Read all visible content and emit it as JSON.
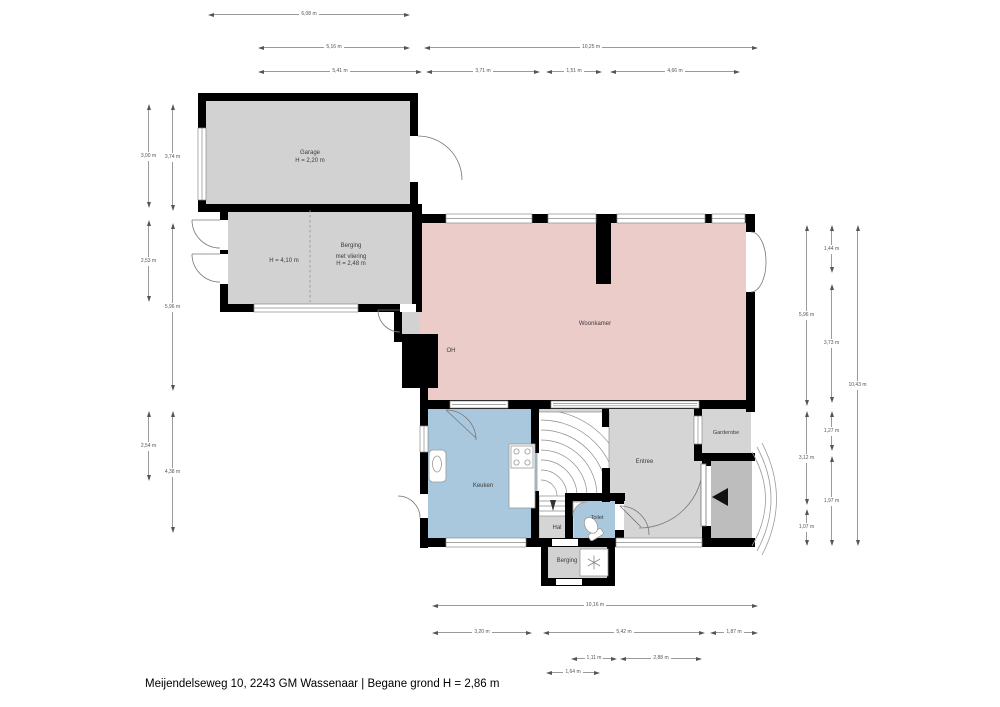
{
  "footer": {
    "title": "Meijendelseweg 10, 2243 GM Wassenaar | Begane grond H = 2,86 m"
  },
  "rooms": {
    "garage": {
      "label": "Garage",
      "height": "H = 2,20 m"
    },
    "garage_annex_height": {
      "label": "H = 4,10 m"
    },
    "berging_attic": {
      "label": "Berging",
      "line2": "met vliering",
      "line3": "H = 2,48 m"
    },
    "woonkamer": {
      "label": "Woonkamer"
    },
    "fireplace": {
      "label": "OH"
    },
    "keuken": {
      "label": "Keuken"
    },
    "entree": {
      "label": "Entree"
    },
    "garderobe": {
      "label": "Garderobe"
    },
    "hal": {
      "label": "Hal"
    },
    "toilet": {
      "label": "Toilet"
    },
    "berging_back": {
      "label": "Berging"
    }
  },
  "dimensions": {
    "top": [
      {
        "label": "6,08 m"
      },
      {
        "label": "5,16 m"
      },
      {
        "label": "10,25 m"
      },
      {
        "label": "5,41 m"
      },
      {
        "label": "3,71 m"
      },
      {
        "label": "1,51 m"
      },
      {
        "label": "4,66 m"
      }
    ],
    "bottom": [
      {
        "label": "10,16 m"
      },
      {
        "label": "3,20 m"
      },
      {
        "label": "5,42 m"
      },
      {
        "label": "1,87 m"
      },
      {
        "label": "1,11 m"
      },
      {
        "label": "2,88 m"
      },
      {
        "label": "1,64 m"
      }
    ],
    "left": [
      {
        "label": "3,00 m"
      },
      {
        "label": "2,53 m"
      },
      {
        "label": "2,54 m"
      },
      {
        "label": "3,74 m"
      },
      {
        "label": "5,96 m"
      },
      {
        "label": "4,38 m"
      }
    ],
    "right": [
      {
        "label": "5,96 m"
      },
      {
        "label": "3,12 m"
      },
      {
        "label": "1,07 m"
      },
      {
        "label": "1,44 m"
      },
      {
        "label": "3,73 m"
      },
      {
        "label": "1,27 m"
      },
      {
        "label": "1,97 m"
      },
      {
        "label": "10,43 m"
      }
    ]
  },
  "colors": {
    "wall": "#000000",
    "living_room_fill": "#ecccc9",
    "kitchen_sanitary_fill": "#a9c8de",
    "storage_fill": "#d2d2d2",
    "porch_fill": "#bdbdbd"
  }
}
